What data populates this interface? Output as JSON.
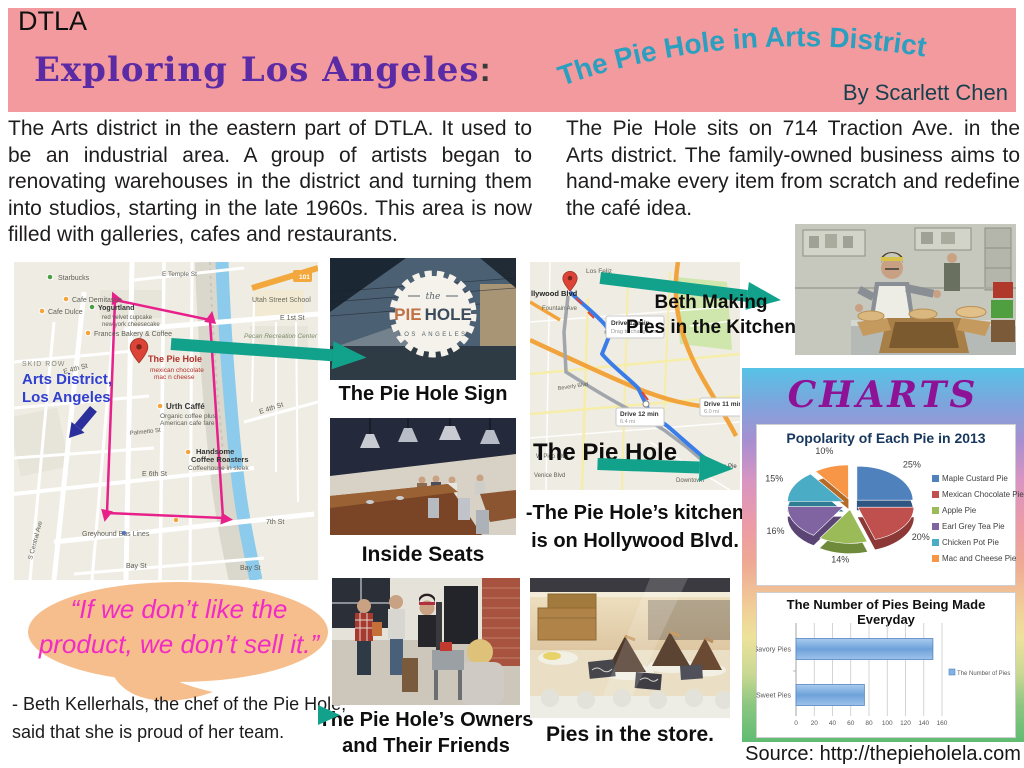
{
  "header": {
    "kicker": "DTLA",
    "title": "Exploring Los Angeles",
    "colon": ":",
    "arc_title": "The Pie Hole in Arts District",
    "byline": "By Scarlett Chen"
  },
  "intro": {
    "left": "The Arts district in the eastern part of DTLA. It used to be an industrial area. A group of artists began to renovating warehouses in the district and turning them into studios, starting in the late 1960s. This area is now filled with galleries, cafes and restaurants.",
    "right": "The Pie Hole sits on 714 Traction Ave. in the Arts district. The family-owned business aims to hand-make every item from scratch and redefine the café idea."
  },
  "left_map": {
    "labels": [
      {
        "t": "Starbucks",
        "x": 44,
        "y": 18,
        "s": 7
      },
      {
        "t": "Cafe Demitasse",
        "x": 58,
        "y": 40,
        "s": 7
      },
      {
        "t": "Cafe Dulce",
        "x": 34,
        "y": 52,
        "s": 7
      },
      {
        "t": "Yogurtland",
        "x": 84,
        "y": 48,
        "s": 7,
        "b": 1,
        "c": "#333333"
      },
      {
        "t": "red velvet cupcake",
        "x": 88,
        "y": 57,
        "s": 6
      },
      {
        "t": "new york cheesecake",
        "x": 88,
        "y": 64,
        "s": 6
      },
      {
        "t": "Frances Bakery & Coffee",
        "x": 80,
        "y": 74,
        "s": 7
      },
      {
        "t": "The Pie Hole",
        "x": 134,
        "y": 100,
        "s": 9,
        "b": 1,
        "c": "#B3322B"
      },
      {
        "t": "mexican chocolate",
        "x": 136,
        "y": 110,
        "s": 6.5,
        "c": "#B3322B"
      },
      {
        "t": "mac n cheese",
        "x": 140,
        "y": 117,
        "s": 6.5,
        "c": "#B3322B"
      },
      {
        "t": "E Temple St",
        "x": 148,
        "y": 14,
        "s": 6.5
      },
      {
        "t": "Utah Street School",
        "x": 238,
        "y": 40,
        "s": 7,
        "c": "#6B6B5E"
      },
      {
        "t": "E 1st St",
        "x": 266,
        "y": 58,
        "s": 7
      },
      {
        "t": "Pecan Recreation Center",
        "x": 230,
        "y": 76,
        "s": 6.5,
        "i": 1,
        "c": "#7C8B68"
      },
      {
        "t": "SKID ROW",
        "x": 8,
        "y": 104,
        "s": 7,
        "c": "#8A8A80",
        "ls": 1
      },
      {
        "t": "E 4th St",
        "x": 50,
        "y": 112,
        "s": 7,
        "r": -15
      },
      {
        "t": "E 4th St",
        "x": 246,
        "y": 152,
        "s": 7,
        "r": -18
      },
      {
        "t": "Urth Caffé",
        "x": 152,
        "y": 147,
        "s": 8,
        "b": 1,
        "c": "#333333"
      },
      {
        "t": "Organic coffee plus",
        "x": 146,
        "y": 156,
        "s": 6.5
      },
      {
        "t": "American cafe fare",
        "x": 146,
        "y": 163,
        "s": 6.5
      },
      {
        "t": "Palmetto St",
        "x": 116,
        "y": 173,
        "s": 6,
        "r": -6
      },
      {
        "t": "Handsome",
        "x": 182,
        "y": 192,
        "s": 7.5,
        "b": 1,
        "c": "#333333"
      },
      {
        "t": "Coffee Roasters",
        "x": 177,
        "y": 200,
        "s": 7.5,
        "b": 1,
        "c": "#333333"
      },
      {
        "t": "Coffeehouse in sleek",
        "x": 174,
        "y": 208,
        "s": 6.5
      },
      {
        "t": "E 6th St",
        "x": 128,
        "y": 214,
        "s": 7
      },
      {
        "t": "7th St",
        "x": 252,
        "y": 262,
        "s": 7
      },
      {
        "t": "Greyhound Bus Lines",
        "x": 68,
        "y": 274,
        "s": 7
      },
      {
        "t": "Bay St",
        "x": 112,
        "y": 306,
        "s": 7
      },
      {
        "t": "Bay St",
        "x": 226,
        "y": 308,
        "s": 7
      },
      {
        "t": "S Central Ave",
        "x": 18,
        "y": 298,
        "s": 6.5,
        "r": -75
      },
      {
        "t": "101",
        "x": 285,
        "y": 17,
        "s": 6.5,
        "b": 1,
        "c": "#ffffff"
      },
      {
        "t": "Arts District,",
        "x": 8,
        "y": 122,
        "s": 15,
        "b": 1,
        "c": "#2F3FD0"
      },
      {
        "t": "Los Angeles",
        "x": 8,
        "y": 140,
        "s": 15,
        "b": 1,
        "c": "#2F3FD0"
      }
    ]
  },
  "middle_map": {
    "labels": [
      {
        "t": "Los Feliz",
        "x": 56,
        "y": 11,
        "s": 6.5
      },
      {
        "t": "llywood Blvd",
        "x": 1,
        "y": 34,
        "s": 7.5,
        "b": 1,
        "c": "#222222"
      },
      {
        "t": "Fountain Ave",
        "x": 12,
        "y": 48,
        "s": 6
      },
      {
        "t": "Beverly Blvd",
        "x": 28,
        "y": 128,
        "s": 5.5,
        "r": -8
      },
      {
        "t": "W Pico Blvd",
        "x": 6,
        "y": 196,
        "s": 6
      },
      {
        "t": "Venice Blvd",
        "x": 4,
        "y": 215,
        "s": 6
      },
      {
        "t": "Downtown",
        "x": 146,
        "y": 220,
        "s": 6
      },
      {
        "t": "The Pie",
        "x": 186,
        "y": 206,
        "s": 6,
        "c": "#333333"
      }
    ],
    "box1_title": "Drive 12 min",
    "box1_sub": "Drag to change rou",
    "box2_title": "Drive 12 min",
    "box2_sub": "6.4 mi",
    "box3_title": "Drive 11 min",
    "box3_sub": "6.0 mi",
    "overlay": "The Pie Hole"
  },
  "sign_badge": {
    "the": "the",
    "pie": "PIE",
    "hole": "HOLE",
    "city": "LOS ANGELES"
  },
  "captions": {
    "sign": "The Pie Hole Sign",
    "inside": "Inside Seats",
    "owners_line1": "The Pie Hole’s Owners",
    "owners_line2": "and Their Friends",
    "pies": "Pies in the store.",
    "beth_line1": "Beth Making",
    "beth_line2": "Pies in the Kitchen",
    "note_line1": "-The Pie Hole’s kitchen",
    "note_line2": "is on Hollywood Blvd."
  },
  "quote": {
    "line1": "“If we don’t like the",
    "line2": "product, we don’t sell it.”"
  },
  "attribution": {
    "line1": "- Beth Kellerhals, the chef of the Pie Hole,",
    "line2": "said that she is proud of her team."
  },
  "charts_section": {
    "heading": "CHARTS",
    "source": "Source: http://thepieholela.com"
  },
  "chart_data": [
    {
      "type": "pie",
      "style": "3d-exploded",
      "title": "Popolarity of Each Pie in 2013",
      "labels": [
        "Maple Custard Pie",
        "Mexican Chocolate Pie",
        "Apple Pie",
        "Earl Grey Tea Pie",
        "Chicken Pot Pie",
        "Mac and Cheese Pie"
      ],
      "values": [
        25,
        20,
        14,
        16,
        15,
        10
      ],
      "colors": [
        "#4F81BD",
        "#C0504D",
        "#9BBB59",
        "#8064A2",
        "#4BACC6",
        "#F79646"
      ],
      "colors_dark": [
        "#2F5583",
        "#8C3836",
        "#6F8A3B",
        "#5A4575",
        "#2F7D94",
        "#B56A28"
      ],
      "legend_position": "right"
    },
    {
      "type": "bar",
      "orientation": "horizontal",
      "title": "The Number of Pies Being Made Everyday",
      "categories": [
        "Savory Pies",
        "Sweet Pies"
      ],
      "values": [
        150,
        75
      ],
      "series_name": "The Number of Pies",
      "xlim": [
        0,
        160
      ],
      "xticks": [
        0,
        20,
        40,
        60,
        80,
        100,
        120,
        140,
        160
      ],
      "bar_color": "#7FB2E5",
      "grid": true,
      "legend_position": "right"
    }
  ]
}
